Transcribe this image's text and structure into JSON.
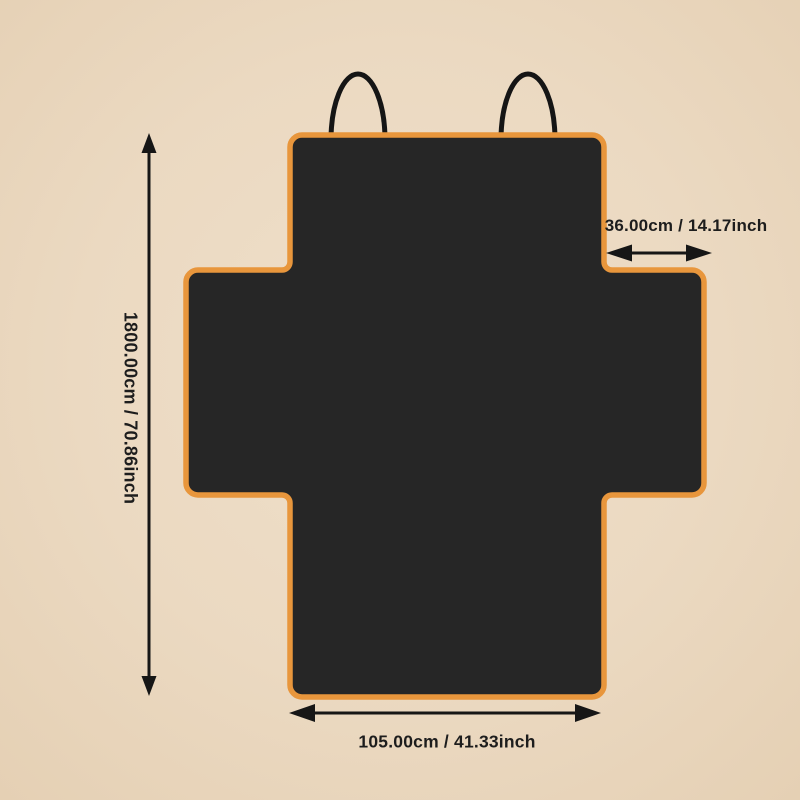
{
  "scene": {
    "description": "Pet car seat cover product dimension diagram",
    "background_color": "#ebd9c1",
    "cover_color": "#262626",
    "trim_color": "#e8963c",
    "strap_color": "#151515",
    "arrow_color": "#161616",
    "text_color": "#1d1d1d"
  },
  "dimensions": {
    "height": {
      "label": "1800.00cm / 70.86inch"
    },
    "side_flap": {
      "label": "36.00cm / 14.17inch"
    },
    "bottom_width": {
      "label": "105.00cm / 41.33inch"
    }
  }
}
